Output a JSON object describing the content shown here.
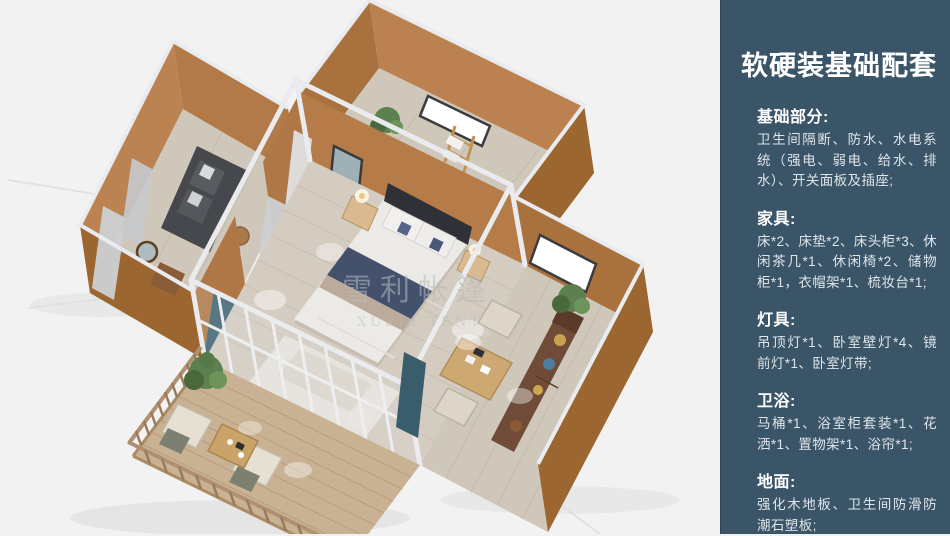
{
  "panel": {
    "title": "软硬装基础配套",
    "background_color": "#3a5468",
    "sections": [
      {
        "heading": "基础部分:",
        "body": "卫生间隔断、防水、水电系统（强电、弱电、给水、排水）、开关面板及插座;"
      },
      {
        "heading": "家具:",
        "body": "床*2、床垫*2、床头柜*3、休闲茶几*1、休闲椅*2、储物柜*1，衣帽架*1、梳妆台*1;"
      },
      {
        "heading": "灯具:",
        "body": "吊顶灯*1、卧室壁灯*4、镜前灯*1、卧室灯带;"
      },
      {
        "heading": "卫浴:",
        "body": "马桶*1、浴室柜套装*1、花洒*1、置物架*1、浴帘*1;"
      },
      {
        "heading": "地面:",
        "body": "强化木地板、卫生间防滑防潮石塑板;"
      }
    ]
  },
  "scene": {
    "watermark": {
      "cn": "雪利帐篷",
      "en": "XUELI TENT"
    },
    "colors": {
      "background": "#f2f2f3",
      "wall_tan": "#b27a48",
      "wall_tan_dark": "#9c6631",
      "floor_wood": "#d4ccc0",
      "deck_wood": "#c9b193",
      "frame_white": "#e9ebee",
      "bed_navy": "#44516d",
      "plant_green": "#5d8050",
      "curtain_teal": "#3f6373"
    }
  }
}
